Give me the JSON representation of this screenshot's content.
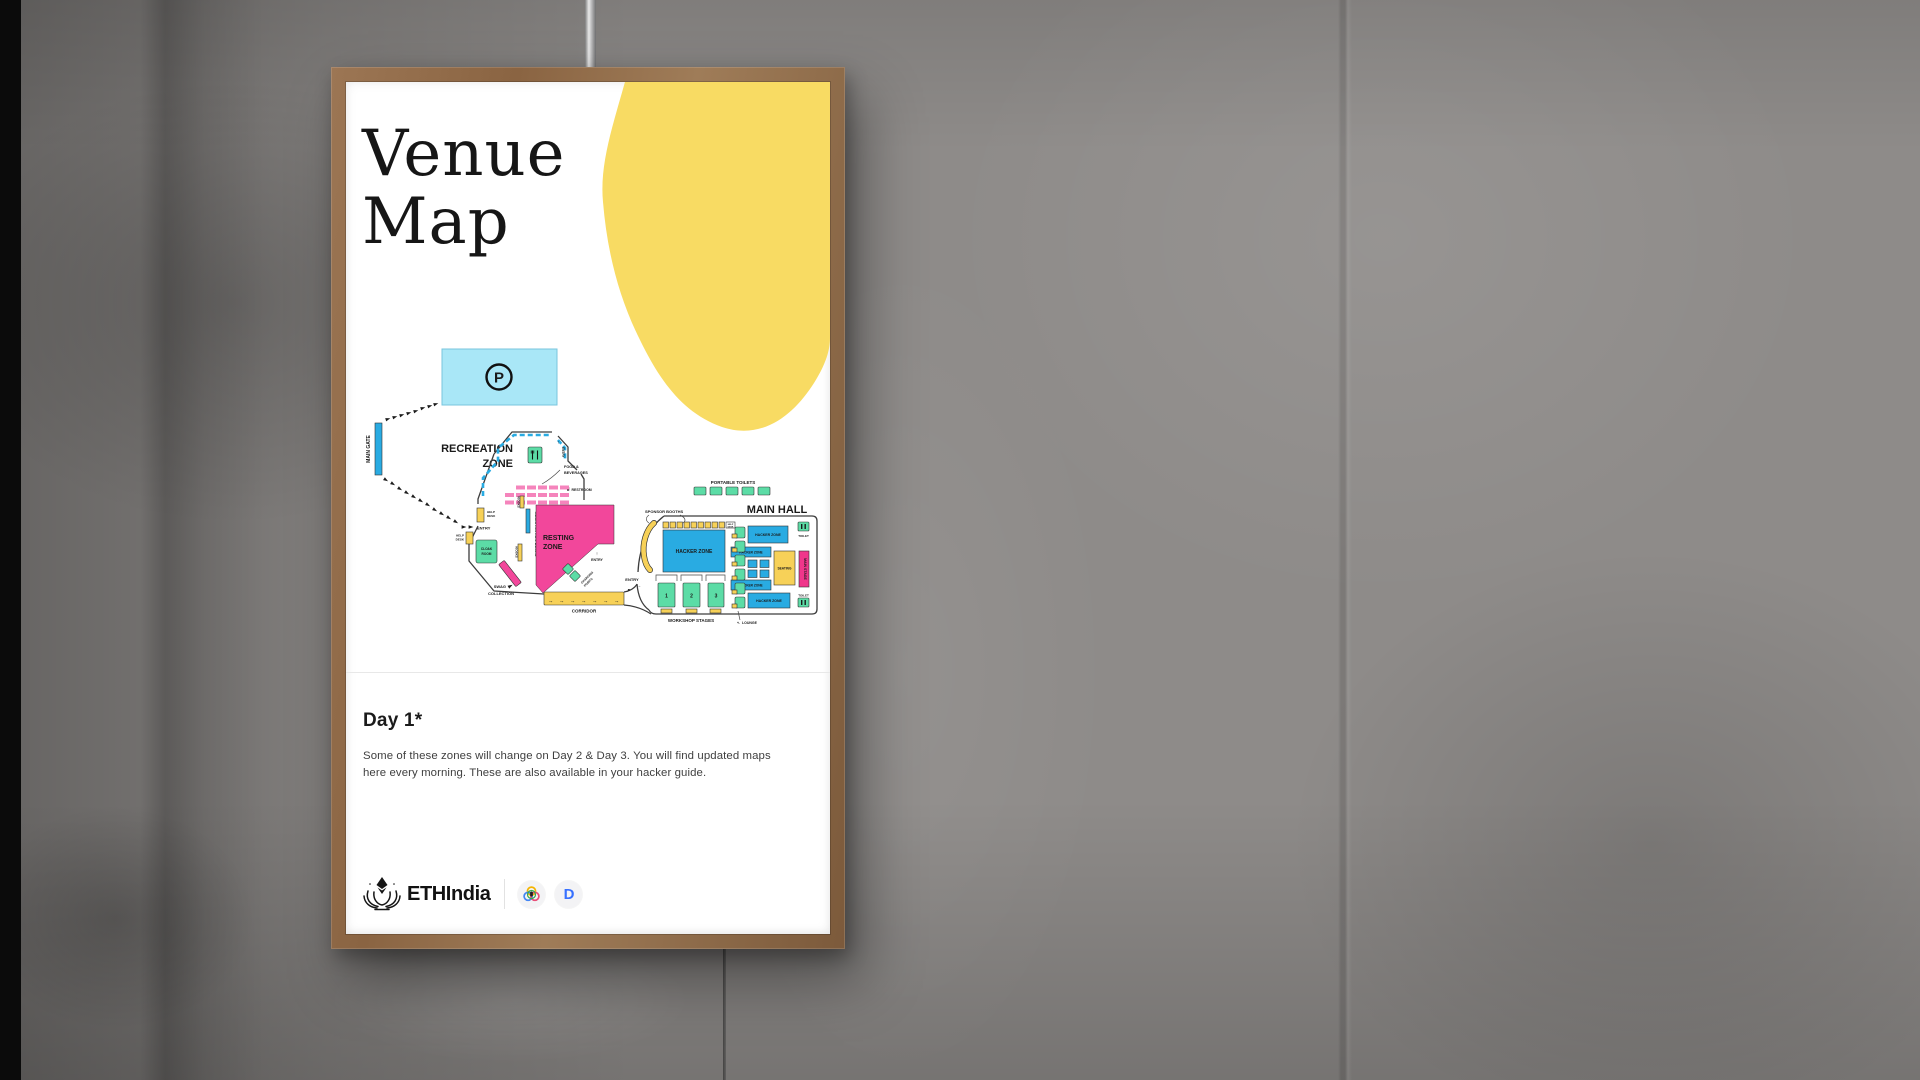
{
  "poster": {
    "title_line1": "Venue",
    "title_line2": "Map",
    "day_heading": "Day 1*",
    "note_line1": "Some of these zones will change on Day 2 & Day 3. You will find updated maps",
    "note_line2": "here every morning. These are also available in your hacker guide.",
    "accent_blob_color": "#F8DB63"
  },
  "branding": {
    "brand_name": "ETHIndia",
    "devfolio_letter": "D",
    "devfolio_blue": "#3770FF"
  },
  "map": {
    "labels": {
      "main_gate": "MAIN GATE",
      "parking_p": "P",
      "recreation_l1": "RECREATION",
      "recreation_l2": "ZONE",
      "entry": "ENTRY",
      "food_l1": "FOOD &",
      "food_l2": "BEVERAGES",
      "restroom": "RESTROOM",
      "help_l1": "HELP",
      "help_l2": "DESK",
      "cloak_l1": "CLOAK",
      "cloak_l2": "ROOM",
      "kiosks": "KIOSKS",
      "registration": "REGISTRATION DESKS",
      "resting_l1": "RESTING",
      "resting_l2": "ZONE",
      "charging_l1": "CHARGING",
      "charging_l2": "POINTS",
      "swag_l1": "SWAG",
      "swag_l2": "COLLECTION",
      "corridor": "CORRIDOR",
      "portable_toilets": "PORTABLE TOILETS",
      "main_hall": "MAIN HALL",
      "sponsor_booths": "SPONSOR BOOTHS",
      "hacker_zone": "HACKER ZONE",
      "seating": "SEATING",
      "main_stage": "MAIN STAGE",
      "toilet": "TOILET",
      "lounge": "LOUNGE",
      "workshop_stages": "WORKSHOP STAGES",
      "stages": [
        "1",
        "2",
        "3"
      ]
    },
    "glyphs": {
      "right": "→",
      "up": "↑",
      "upright": "↗",
      "left": "←",
      "upleft": "↖"
    },
    "colors": {
      "blue": "#29ABE2",
      "pink": "#F2479B",
      "light_pink": "#F584BC",
      "green": "#5CDCA6",
      "yellow": "#F7D158",
      "cyan": "#A9E7F7",
      "magenta": "#F0368B",
      "outline": "#3d3d3d"
    }
  }
}
